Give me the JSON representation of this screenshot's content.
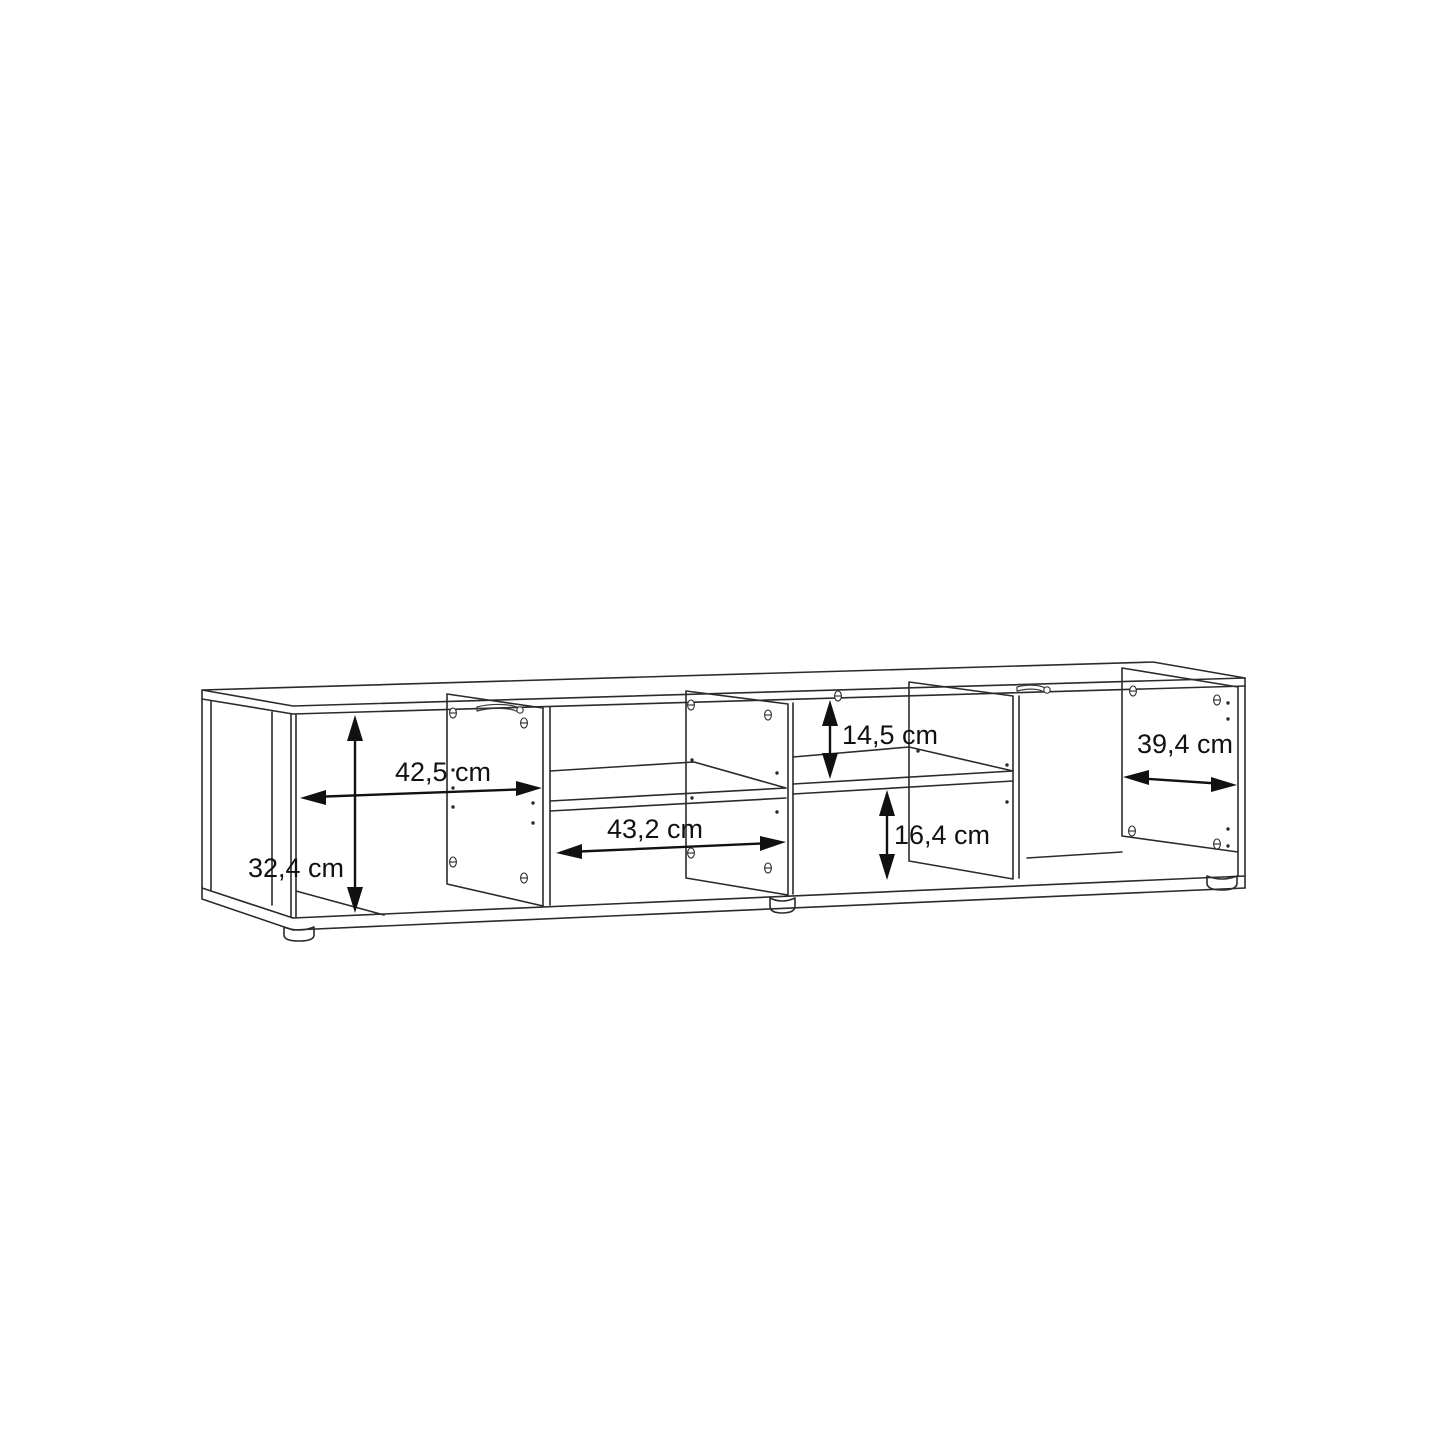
{
  "page": {
    "background_color": "#ffffff"
  },
  "diagram": {
    "kind": "furniture dimension line drawing",
    "subject": "Low TV board / sideboard shown in perspective with four open compartments, two fixed shelves, cam and pin hole markings and three round plinth feet",
    "line_color": "#2b2b2b",
    "label_color": "#111111",
    "unit": "cm",
    "decimal_separator": ","
  },
  "symbols": {
    "cam_hole": "small theta-shaped drilled hole marker",
    "pin_hole": "small dot marker"
  },
  "dimensions": [
    {
      "id": "left-compartment-width",
      "label": "42,5 cm",
      "value": 42.5,
      "unit": "cm",
      "orientation": "horizontal",
      "location": "inner width of left compartment"
    },
    {
      "id": "inner-height",
      "label": "32,4 cm",
      "value": 32.4,
      "unit": "cm",
      "orientation": "vertical",
      "location": "inner height of left compartment"
    },
    {
      "id": "center-compartment-width",
      "label": "43,2 cm",
      "value": 43.2,
      "unit": "cm",
      "orientation": "horizontal",
      "location": "inner width of center compartment below shelf"
    },
    {
      "id": "upper-niche-height",
      "label": "14,5 cm",
      "value": 14.5,
      "unit": "cm",
      "orientation": "vertical",
      "location": "height above shelf in third compartment"
    },
    {
      "id": "lower-niche-height",
      "label": "16,4 cm",
      "value": 16.4,
      "unit": "cm",
      "orientation": "vertical",
      "location": "height below shelf in third compartment"
    },
    {
      "id": "right-compartment-depth",
      "label": "39,4 cm",
      "value": 39.4,
      "unit": "cm",
      "orientation": "horizontal",
      "location": "inner depth of right compartment"
    }
  ]
}
